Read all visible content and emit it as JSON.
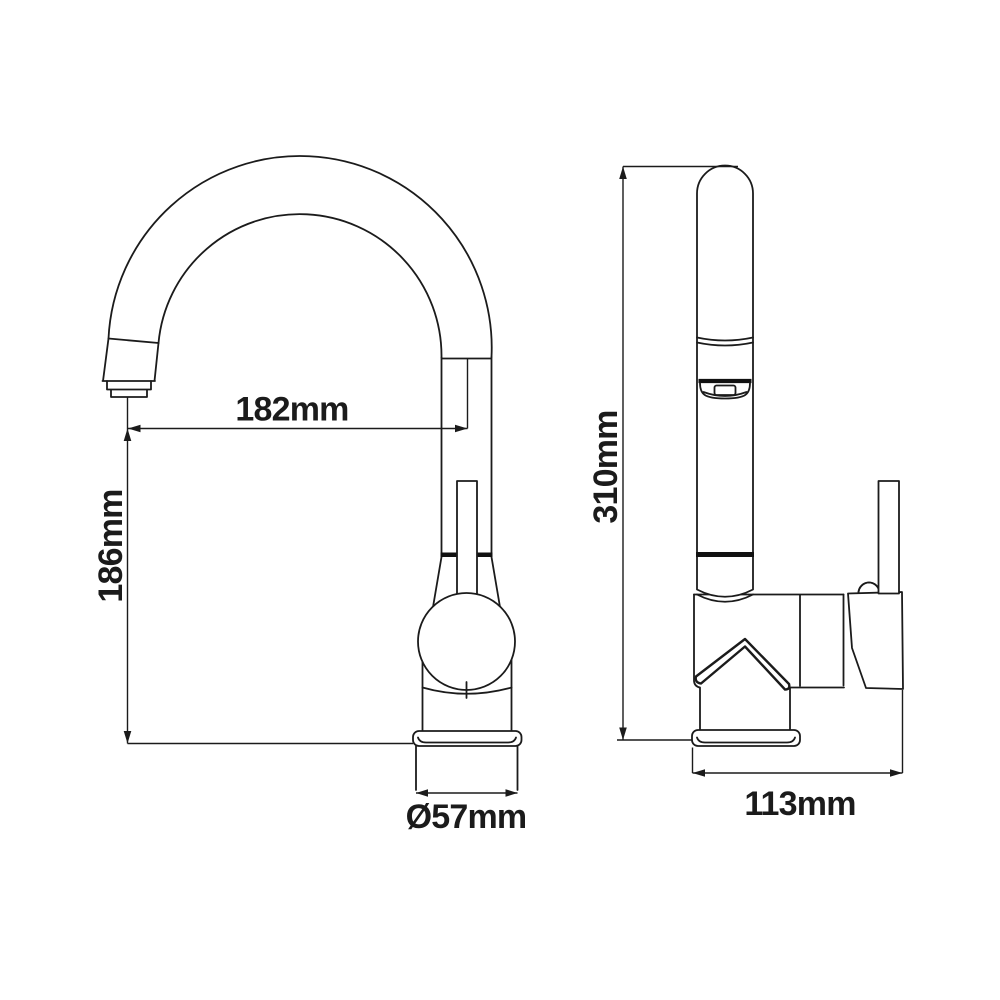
{
  "diagram": {
    "subject": "kitchen-faucet-technical-drawing",
    "background_color": "#ffffff",
    "line_color": "#1b1b1b",
    "views": {
      "side_view": {
        "name": "side view",
        "dimensions": {
          "spout_reach": {
            "label": "182mm",
            "orientation": "horizontal"
          },
          "spout_height": {
            "label": "186mm",
            "orientation": "vertical"
          },
          "base_diameter": {
            "label": "Ø57mm",
            "orientation": "horizontal"
          }
        }
      },
      "front_view": {
        "name": "front view",
        "dimensions": {
          "total_height": {
            "label": "310mm",
            "orientation": "vertical"
          },
          "body_width": {
            "label": "113mm",
            "orientation": "horizontal"
          }
        }
      }
    }
  }
}
